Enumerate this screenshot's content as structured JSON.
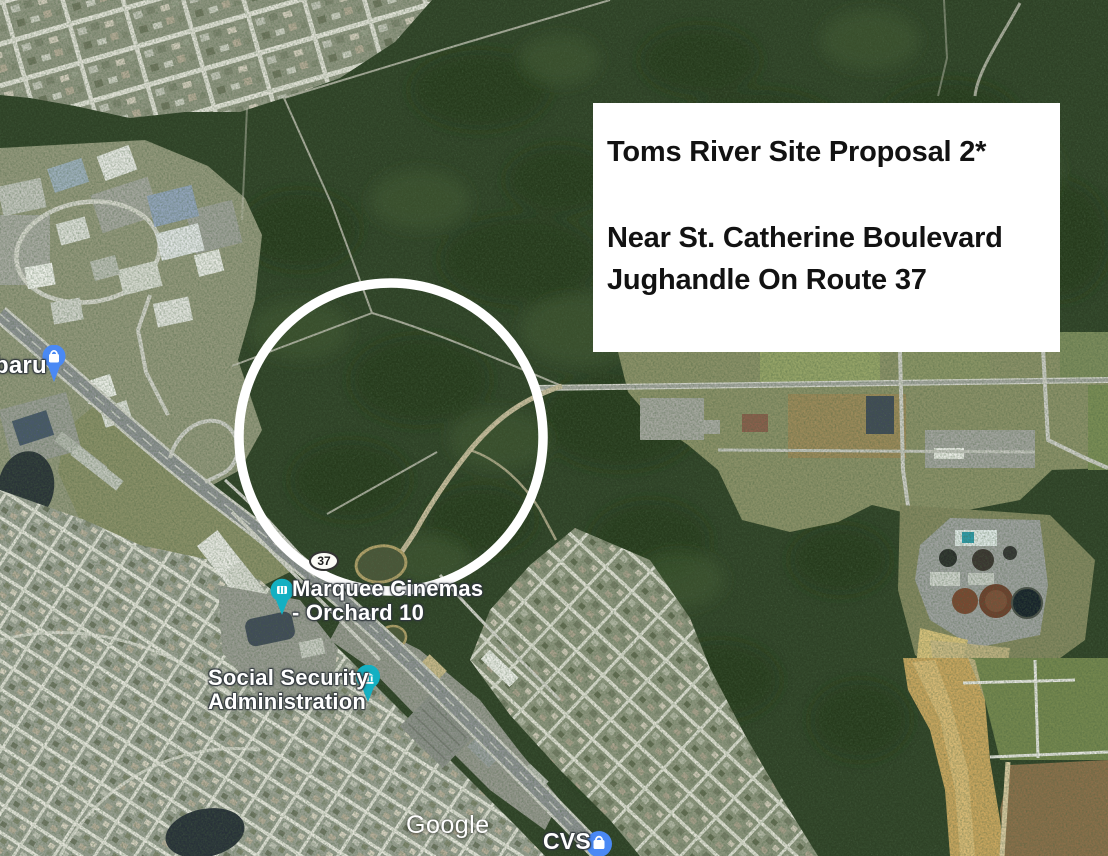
{
  "annotation": {
    "title": "Toms River Site Proposal 2*",
    "line1": "Near St. Catherine Boulevard",
    "line2": "Jughandle On Route 37"
  },
  "map": {
    "attribution": "Google",
    "route_shield": "37",
    "labels": {
      "cinema_line1": "Marquee Cinemas",
      "cinema_line2": "- Orchard 10",
      "ssa_line1": "Social Security",
      "ssa_line2": "Administration",
      "subaru_partial": "baru",
      "cvs": "CVS"
    }
  },
  "theme": {
    "pin-teal": "#14b0c2",
    "pin-blue": "#4a89f4",
    "circle-white": "#ffffff",
    "box-bg": "#ffffff",
    "box-text": "#121212",
    "shield-bg": "#fbfbf6"
  }
}
